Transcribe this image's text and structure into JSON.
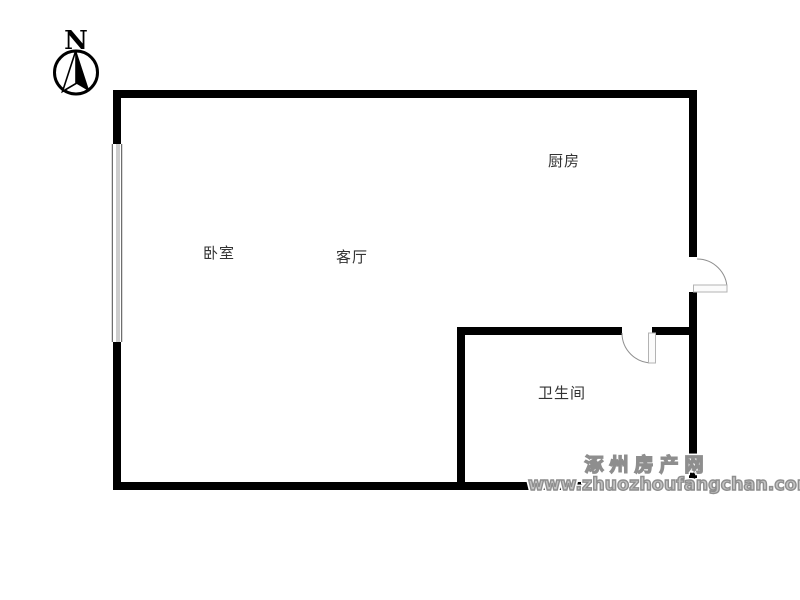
{
  "page": {
    "background_color": "#ffffff",
    "wall_color": "#000000"
  },
  "compass": {
    "north_label": "N"
  },
  "floorplan": {
    "rooms": [
      {
        "id": "bedroom",
        "label": "卧室"
      },
      {
        "id": "living-room",
        "label": "客厅"
      },
      {
        "id": "kitchen",
        "label": "厨房"
      },
      {
        "id": "bathroom",
        "label": "卫生间"
      }
    ]
  },
  "watermark": {
    "site_name": "涿州房产网",
    "site_url": "www.zhuozhoufangchan.com",
    "color": "#8e8e8e"
  }
}
